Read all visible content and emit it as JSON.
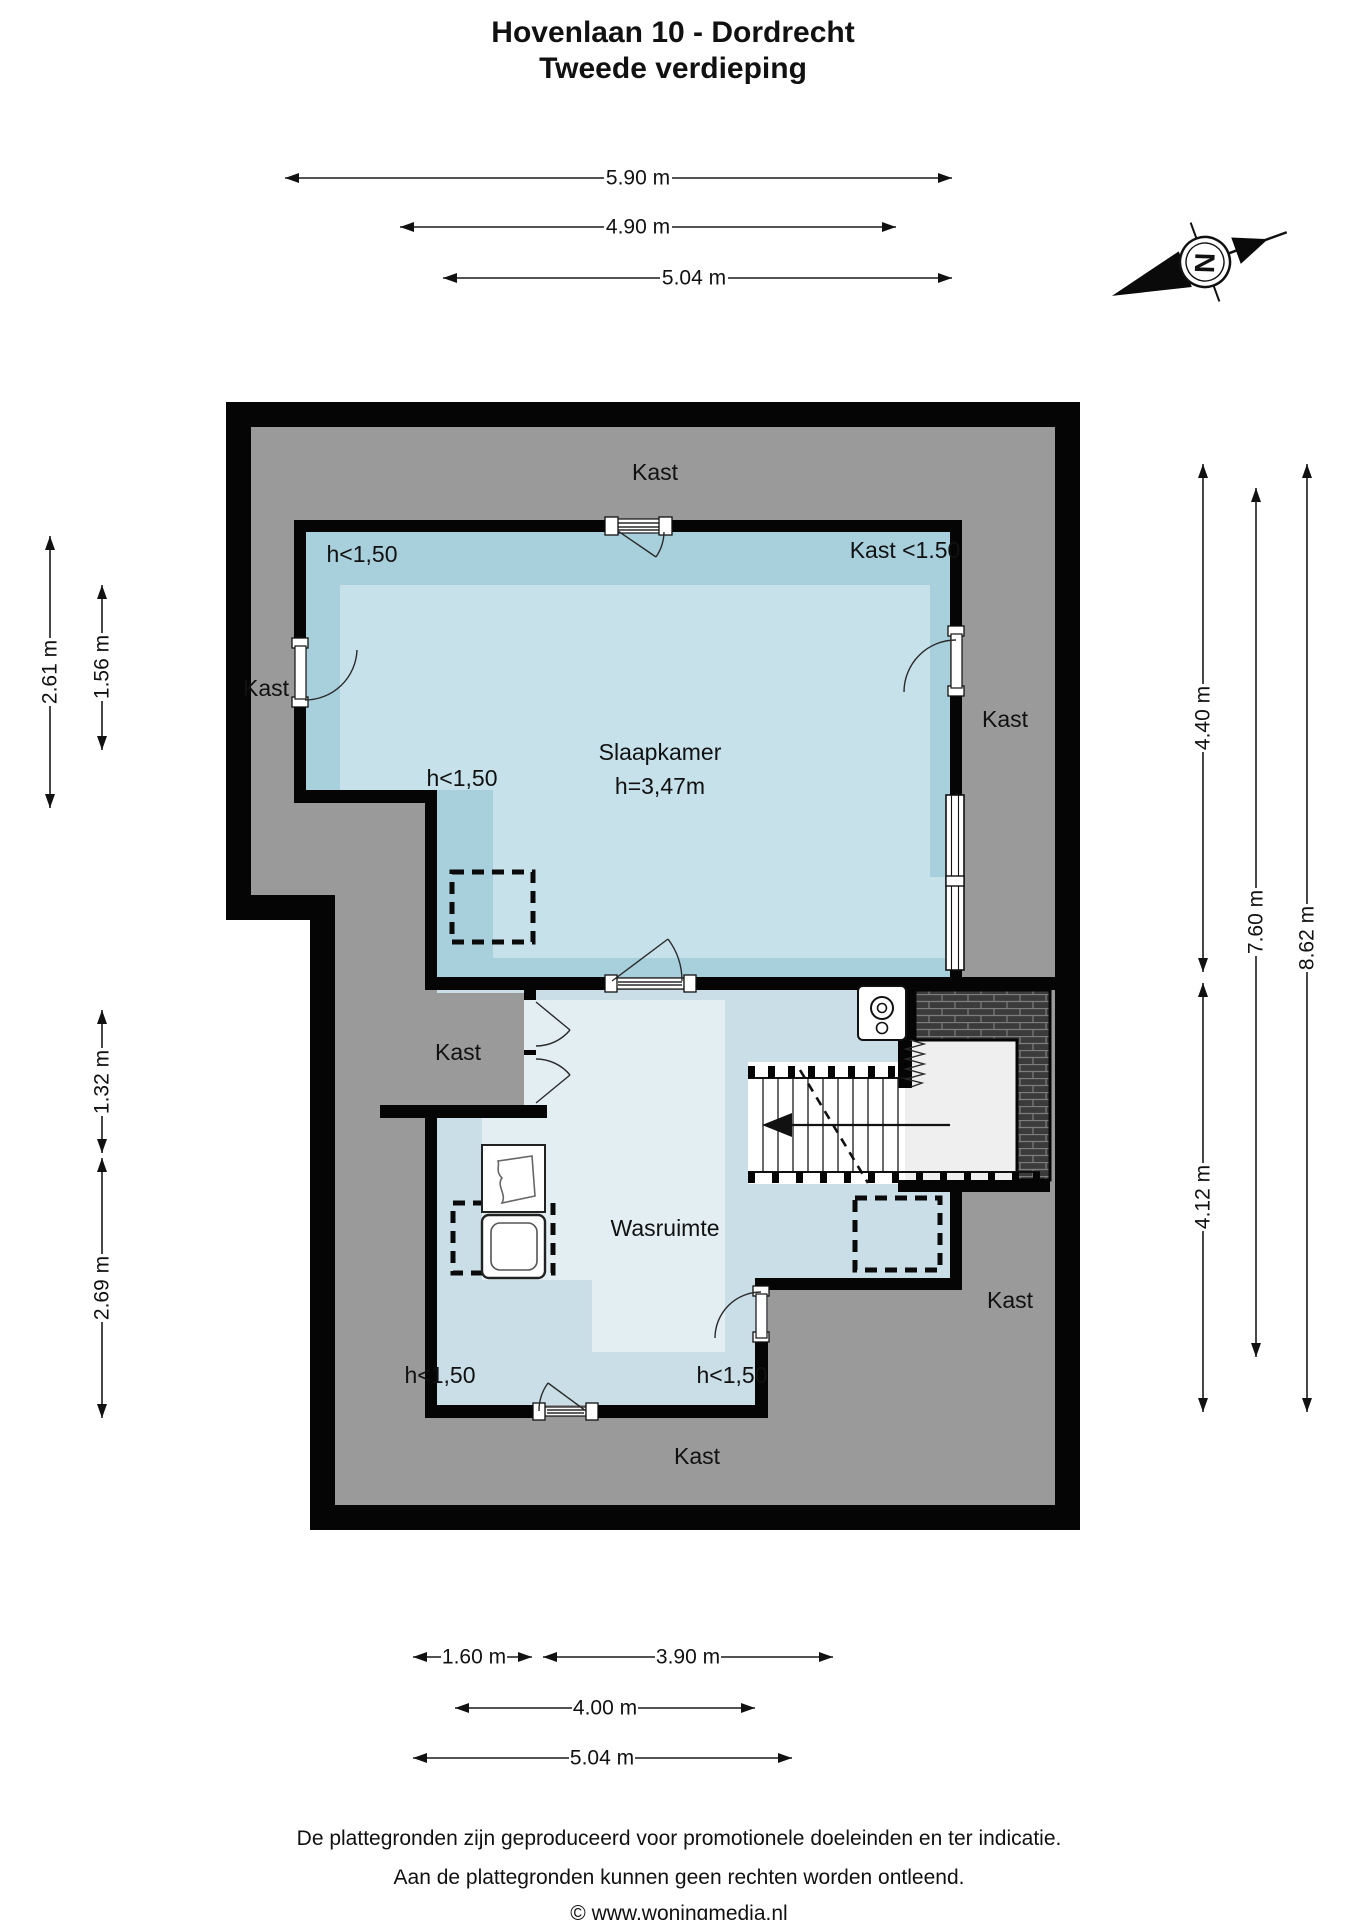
{
  "title": {
    "line1": "Hovenlaan 10 - Dordrecht",
    "line2": "Tweede verdieping"
  },
  "compass": {
    "letter": "N"
  },
  "rooms": {
    "slaapkamer": {
      "name": "Slaapkamer",
      "ceiling_height": "h=3,47m"
    },
    "wasruimte": {
      "name": "Wasruimte"
    },
    "kast_top": "Kast",
    "kast_west": "Kast",
    "kast_east": "Kast",
    "kast_middle": "Kast",
    "kast_southeast": "Kast",
    "kast_bottom": "Kast",
    "kast_lt150": "Kast <1.50",
    "h_lt150_topleft": "h<1,50",
    "h_lt150_midleft": "h<1,50",
    "h_lt150_bottomleft": "h<1,50",
    "h_lt150_bottomright": "h<1,50"
  },
  "dimensions": {
    "top": [
      {
        "label": "5.90 m"
      },
      {
        "label": "4.90 m"
      },
      {
        "label": "5.04 m"
      }
    ],
    "left": [
      {
        "label": "2.61 m"
      },
      {
        "label": "1.56 m"
      },
      {
        "label": "1.32 m"
      },
      {
        "label": "2.69 m"
      }
    ],
    "right": [
      {
        "label": "4.40 m"
      },
      {
        "label": "7.60 m"
      },
      {
        "label": "8.62 m"
      },
      {
        "label": "4.12 m"
      }
    ],
    "bottom": [
      {
        "label": "1.60 m"
      },
      {
        "label": "3.90 m"
      },
      {
        "label": "4.00 m"
      },
      {
        "label": "5.04 m"
      }
    ]
  },
  "footer": {
    "line1": "De plattegronden zijn geproduceerd voor promotionele doeleinden en ter indicatie.",
    "line2": "Aan de plattegronden kunnen geen rechten worden ontleend.",
    "line3": "© www.woningmedia.nl"
  },
  "colors": {
    "wall": "#050505",
    "attic_gray": "#9a9a9a",
    "slaapkamer_band": "#a8cfdc",
    "slaapkamer_inner": "#c6e1ea",
    "wasruimte_band": "#c9dee6",
    "wasruimte_inner": "#e3eef3",
    "terrace_tile": "#3b3b3b",
    "landing": "#efefef"
  }
}
